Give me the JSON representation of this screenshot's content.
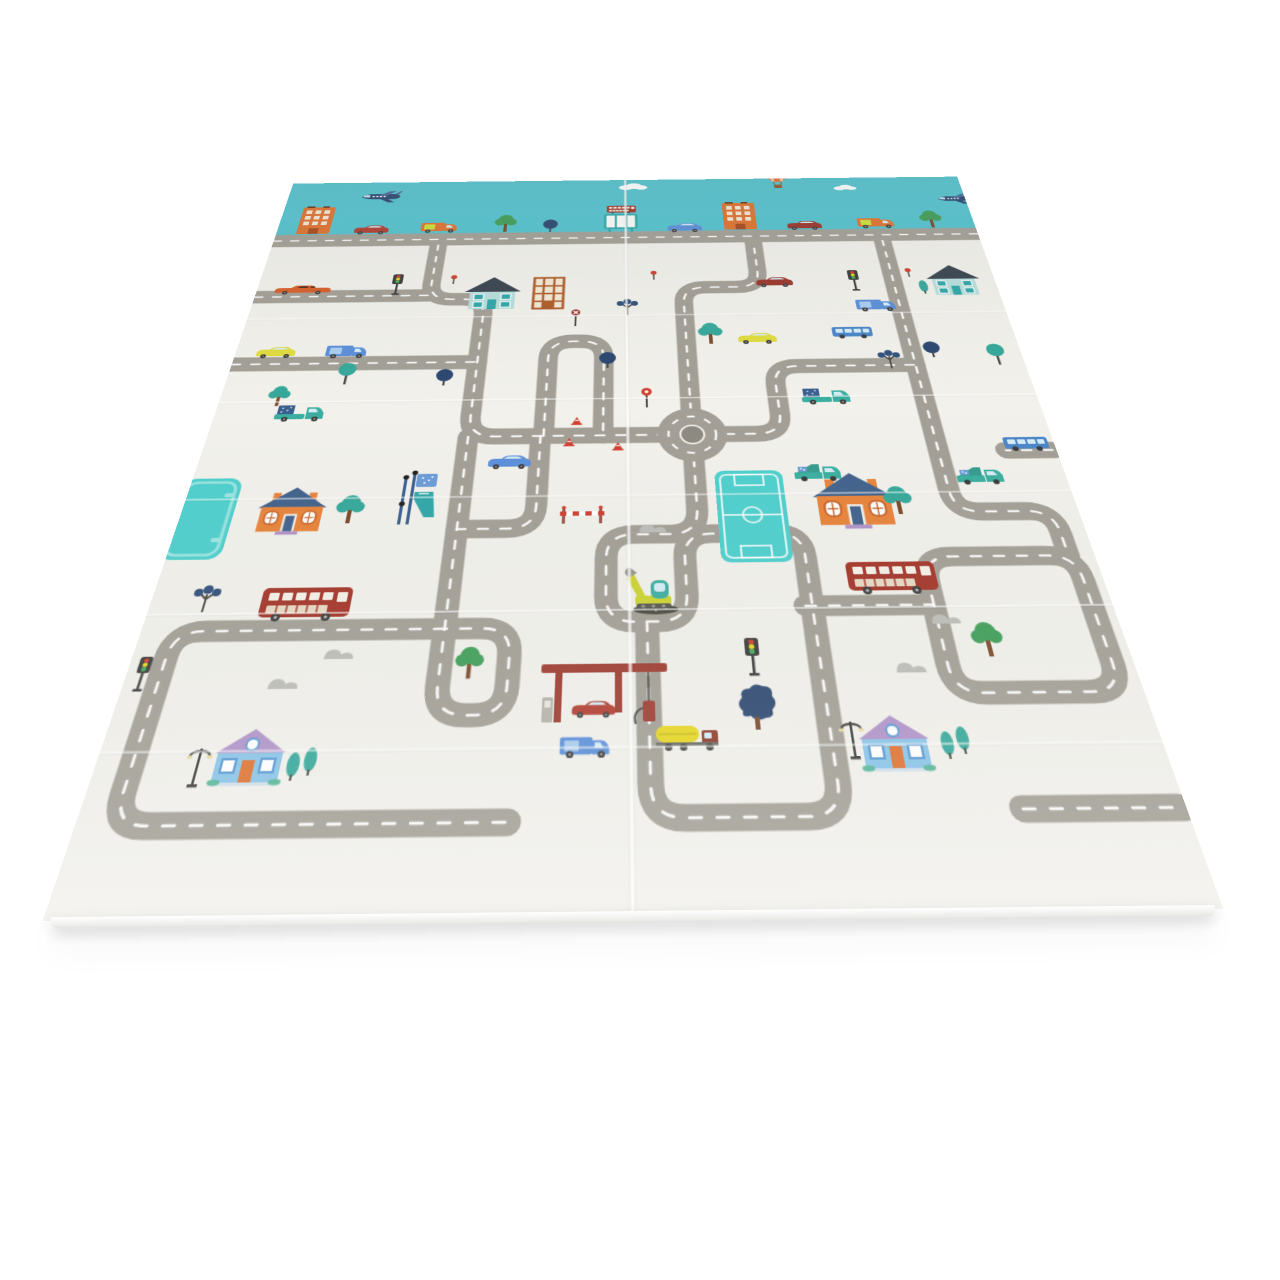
{
  "scene": {
    "type": "product-photo",
    "subject": "foldable baby play mat with cartoon city road-map print",
    "background": "plain white studio background",
    "view": "laid flat, photographed in perspective, slight shadow under front edge"
  },
  "palette": {
    "sky": "#54c3cf",
    "mat": "#f2f1ec",
    "road": "#a39f96",
    "rbCenter": "#8d8a82",
    "red": "#b23c30",
    "maroon": "#9c352c",
    "busRed": "#a43428",
    "yellow": "#e0dc3e",
    "blue": "#5b8fd9",
    "busBlue": "#4a86c8",
    "orange": "#e0722f",
    "panelYellow": "#cde039",
    "teal": "#3aaea0",
    "navy": "#2c4770",
    "cargoNavy": "#3a5f8f",
    "treeGreen": "#3f9e58",
    "trunk": "#7a4a2a",
    "poplar": "#35a89a",
    "berry": "#31507a",
    "houseOrange": "#e8833a",
    "roofSteel": "#41628c",
    "houseTealWall": "#b9dfdc",
    "roofDark": "#39434f",
    "tealAccent": "#2fa7a8",
    "lattice": "#b05c2a",
    "cream": "#f3ead6",
    "houseBlueWall": "#8ac4e8",
    "roofPurple": "#b193c9",
    "doorOrange": "#e0722f",
    "windowBlue": "#5b9bd5",
    "poolTeal": "#4ed0cd",
    "poolLight": "#9ae4e0",
    "hill": "#bdbdb8",
    "dark": "#3a3a3a",
    "gravel": "#4a4a42",
    "excaYellow": "#ccd32f",
    "tankYellow": "#e8d821",
    "cabRed": "#8e3a2c",
    "brick": "#9e3b30",
    "lightRed": "#d04030",
    "lightYellow": "#e8d821",
    "lightGreen": "#3fae58",
    "glass": "#d6ecf5",
    "creamWin": "#f5f1e8"
  },
  "inventory": {
    "vehicles": [
      "airplane x2",
      "hot-air balloon",
      "red sedan",
      "maroon sedan",
      "blue sedan",
      "yellow car x2",
      "blue car",
      "orange delivery van x2",
      "blue van x3",
      "orange limousine",
      "red double-decker bus x2",
      "mini red bus",
      "blue city bus x2",
      "teal pickup truck x2",
      "teal garbage truck x2",
      "yellow fuel tanker",
      "yellow excavator"
    ],
    "buildings": [
      "orange city building x2",
      "teal two-storey house x2",
      "orange lattice building",
      "orange house with blue roof x2",
      "blue house with purple roof x2",
      "gas station",
      "bus-stop billboard",
      "playground slide stand"
    ],
    "nature": [
      "round green trees",
      "teal trees",
      "navy trees",
      "berry trees",
      "poplar trees",
      "grey hills",
      "clouds"
    ],
    "road_items": [
      "roundabout",
      "traffic lights x4",
      "street lamps x2",
      "traffic cones x3",
      "stop sign",
      "round red sign",
      "red berry poles x3",
      "railroad crossing barrier",
      "soccer field",
      "swimming pool"
    ]
  },
  "roads": {
    "h0": "M0 115 H850",
    "b": "M0 215 H200",
    "c": "M0 322 H264",
    "s1": "M200 126 V195 Q200 222 227 222 H237 Q264 222 264 249 V400 Q264 427 291 427 H457",
    "s1ext": "M264 427 V699 Q264 725 290 725 H296 Q322 725 322 699 V671 Q322 645 296 645 H264",
    "busroad": "M264 645 H55 Q29 645 29 671 V786 Q29 812 55 812 H330",
    "snake2": "M337 427 V514 Q337 540 311 540 H264",
    "loopcl": "M340 427 V318 Q340 292 366 292 H374 Q400 292 400 318 V427",
    "rbn": "M490 394 V232 Q490 206 516 206 H552 Q578 206 578 180 V126",
    "rbe": "M523 427 H555 Q581 427 581 401 V359 Q581 333 607 333 H733",
    "rbs": "M490 459 V520 Q490 548 464 548 L430 548 Q404 548 404 574 V614 Q404 640 430 640 L450 640 Q476 640 476 614 V574 Q476 548 502 548 L560 548 Q586 548 586 574 V784 Q586 810 560 810 H466 Q440 810 440 784 V640",
    "rbe2": "M580 626 H693",
    "brloop": "M693 626 V602 Q693 576 719 576 H806 Q832 576 832 602 V684 Q832 710 806 710 H719 Q693 710 693 684 V626",
    "vr": "M733 126 V500 Q733 526 759 526 H800 Q826 526 826 552 V576",
    "stub1": "M846 452 H800",
    "stub2": "M725 806 H846"
  },
  "pos": {
    "plane1": "translate(88,16) scale(1.15)",
    "plane2": "translate(812,34)",
    "balloon": "translate(596,-36)",
    "cloud1": "translate(416,6)",
    "cloud2": "translate(688,14) scale(0.8)",
    "citybldg1": "translate(22,48)",
    "citybldg2": "translate(543,48)",
    "skycar_red": "translate(92,86)",
    "skyvan1": "translate(174,81)",
    "skytree1": "translate(264,66)",
    "skynavytree": "translate(323,78)",
    "shelter": "translate(398,69)",
    "shelterbus": "translate(401,52) scale(0.45)",
    "skycar_blue": "translate(474,88)",
    "skycar_maroon": "translate(620,86)",
    "skyvan2": "translate(707,81)",
    "skytree2": "translate(785,66)",
    "limo": "translate(20,195)",
    "tl1": "translate(152,178)",
    "houseteal1": "translate(240,183)",
    "lattice": "translate(316,184)",
    "dot1": "translate(220,180)",
    "dot2": "translate(452,176)",
    "dot3": "translate(748,176)",
    "car_maroon2": "translate(573,189)",
    "tl2": "translate(680,179)",
    "houseteal2": "translate(772,170) scale(0.95)",
    "poplar5": "translate(760,198)",
    "berry2": "translate(414,220)",
    "treegreen3": "translate(503,262)",
    "car_yellow1": "translate(21,295)",
    "van_blue1": "translate(97,293)",
    "treeteal1": "translate(115,321)",
    "treenavy1": "translate(221,331)",
    "treenavy2": "translate(394,308)",
    "stopsign": "translate(360,240)",
    "car_yellow2": "translate(545,281)",
    "bus_blue1": "translate(650,272)",
    "van_blue2": "translate(683,228)",
    "berry3": "translate(695,306)",
    "treenavy3": "translate(745,297)",
    "treeteal2": "translate(812,302)",
    "treegreen_sm": "translate(49,352) scale(0.85)",
    "pickup1": "translate(61,380)",
    "pickup2": "translate(605,364)",
    "lolli": "translate(437,362)",
    "cone1": "translate(367,401)",
    "cone2": "translate(360,429)",
    "cone3": "translate(409,435)",
    "car_blue1": "translate(285,451)",
    "pool": "translate(-8,477)",
    "slide": "translate(203,470)",
    "field": "translate(509,474)",
    "houseorange1": "translate(71,487) scale(1.05)",
    "treegreen1": "translate(146,496)",
    "houseorange2": "translate(600,476) scale(1.25)",
    "treegreen2": "translate(668,492)",
    "crossing": "translate(358,514)",
    "hills3": "translate(428,533)",
    "garbage1": "translate(585,462)",
    "garbage2": "translate(742,468)",
    "bus_blue2": "translate(799,433)",
    "exca": "translate(418,583)",
    "bus_red1": "translate(96,600)",
    "bus_red2": "translate(619,579)",
    "berry1": "translate(36,594)",
    "hills1": "translate(157,660)",
    "hills2": "translate(115,687)",
    "treegreen4": "translate(276,660) scale(0.9)",
    "tl4": "translate(6,669) scale(0.9)",
    "hills4": "translate(681,632)",
    "hills5": "translate(642,678)",
    "treegreen5": "translate(718,641)",
    "gas": "translate(350,680)",
    "car_red2": "translate(375,713) scale(0.85)",
    "van_blue3": "translate(367,743) scale(0.9)",
    "tanker": "translate(443,731)",
    "tl3": "translate(521,657)",
    "navyblob": "translate(511,698)",
    "lamp2": "translate(592,729)",
    "houseblue2": "translate(606,727)",
    "poplar3": "translate(672,743)",
    "poplar4": "translate(685,739)",
    "lamp1": "translate(70,746)",
    "houseblue1": "translate(91,733)",
    "poplar1": "translate(151,755)",
    "poplar2": "translate(164,751)",
    "roundabout": "translate(490,427)"
  }
}
